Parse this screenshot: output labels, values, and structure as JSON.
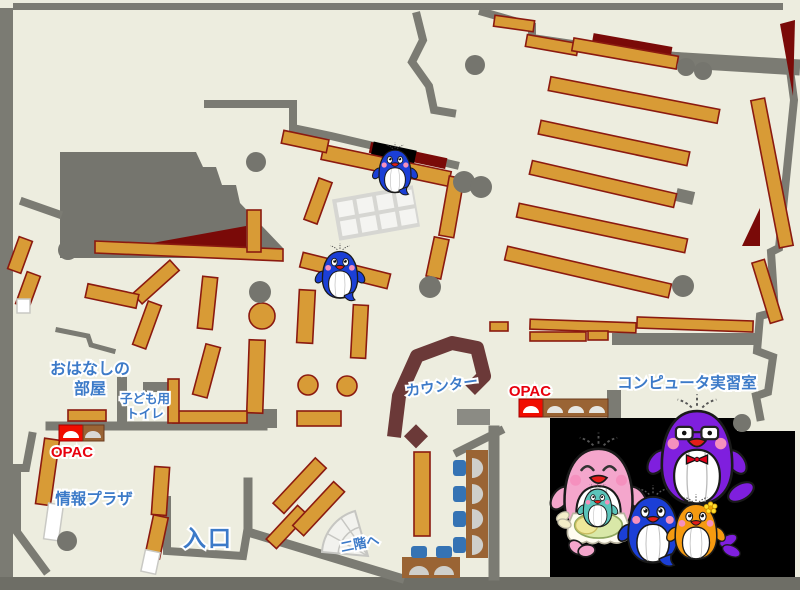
{
  "map": {
    "labels": {
      "storytelling_room_line1": "おはなしの",
      "storytelling_room_line2": "部屋",
      "kids_toilet_line1": "子ども用",
      "kids_toilet_line2": "トイレ",
      "opac_children": "OPAC",
      "opac_main": "OPAC",
      "info_plaza": "情報プラザ",
      "entrance": "入口",
      "counter": "カウンター",
      "to_second_floor": "二階へ",
      "computer_room": "コンピュータ実習室"
    },
    "colors": {
      "floor": "#EDEDDF",
      "wall": "#7B7B73",
      "bookshelf": "#D89B36",
      "bookshelf_border": "#8B1A10",
      "dark_red_area": "#7A0A08",
      "counter": "#6B3938",
      "label_blue": "#3C7AC8",
      "opac_red": "#E8000D",
      "chair_blue": "#3573B4",
      "desk_brown": "#9A6434",
      "mascot_panel": "#000000",
      "mascot_pink": "#F4A6CC",
      "mascot_blue": "#1B3FD6",
      "mascot_purple": "#7F1FDE",
      "mascot_orange": "#F59A10",
      "mascot_teal": "#5BC4BA"
    }
  }
}
